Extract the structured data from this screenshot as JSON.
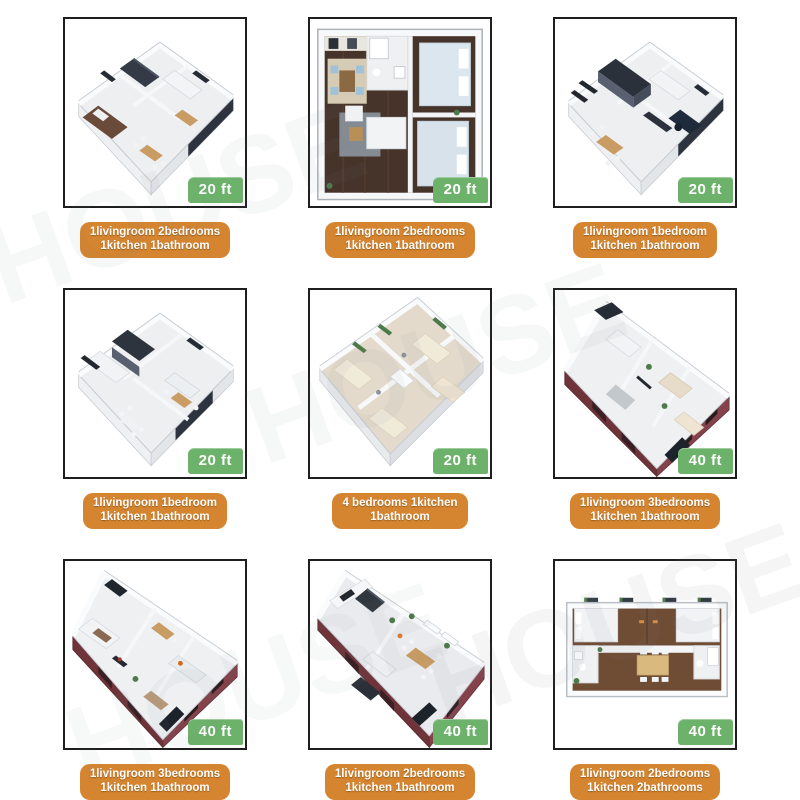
{
  "page": {
    "background": "#ffffff",
    "watermark_text": "HOUSE"
  },
  "colors": {
    "badge_green": "#6cb26a",
    "label_orange": "#d5842f",
    "tile_border": "#1e1e1e",
    "badge_text": "#ffffff",
    "label_text": "#ffffff"
  },
  "tiles": [
    {
      "id": "plan-1",
      "badge": "20 ft",
      "label_line1": "1livingroom 2bedrooms",
      "label_line2": "1kitchen 1bathroom",
      "plan_style": "iso-square-white-2bed"
    },
    {
      "id": "plan-2",
      "badge": "20 ft",
      "label_line1": "1livingroom 2bedrooms",
      "label_line2": "1kitchen 1bathroom",
      "plan_style": "topdown-square-darkwood"
    },
    {
      "id": "plan-3",
      "badge": "20 ft",
      "label_line1": "1livingroom 1bedroom",
      "label_line2": "1kitchen 1bathroom",
      "plan_style": "iso-square-white-office"
    },
    {
      "id": "plan-4",
      "badge": "20 ft",
      "label_line1": "1livingroom 1bedroom",
      "label_line2": "1kitchen 1bathroom",
      "plan_style": "iso-square-white-1bed"
    },
    {
      "id": "plan-5",
      "badge": "20 ft",
      "label_line1": "4 bedrooms 1kitchen",
      "label_line2": "1bathroom",
      "plan_style": "iso-square-4bed-tan"
    },
    {
      "id": "plan-6",
      "badge": "40 ft",
      "label_line1": "1livingroom 3bedrooms",
      "label_line2": "1kitchen 1bathroom",
      "plan_style": "iso-long-maroon-3bed"
    },
    {
      "id": "plan-7",
      "badge": "40 ft",
      "label_line1": "1livingroom 3bedrooms",
      "label_line2": "1kitchen 1bathroom",
      "plan_style": "iso-long-maroon-3bed-b"
    },
    {
      "id": "plan-8",
      "badge": "40 ft",
      "label_line1": "1livingroom 2bedrooms",
      "label_line2": "1kitchen 1bathroom",
      "plan_style": "iso-long-maroon-2bed"
    },
    {
      "id": "plan-9",
      "badge": "40 ft",
      "label_line1": "1livingroom 2bedrooms",
      "label_line2": "1kitchen 2bathrooms",
      "plan_style": "topdown-wide-brown"
    }
  ]
}
